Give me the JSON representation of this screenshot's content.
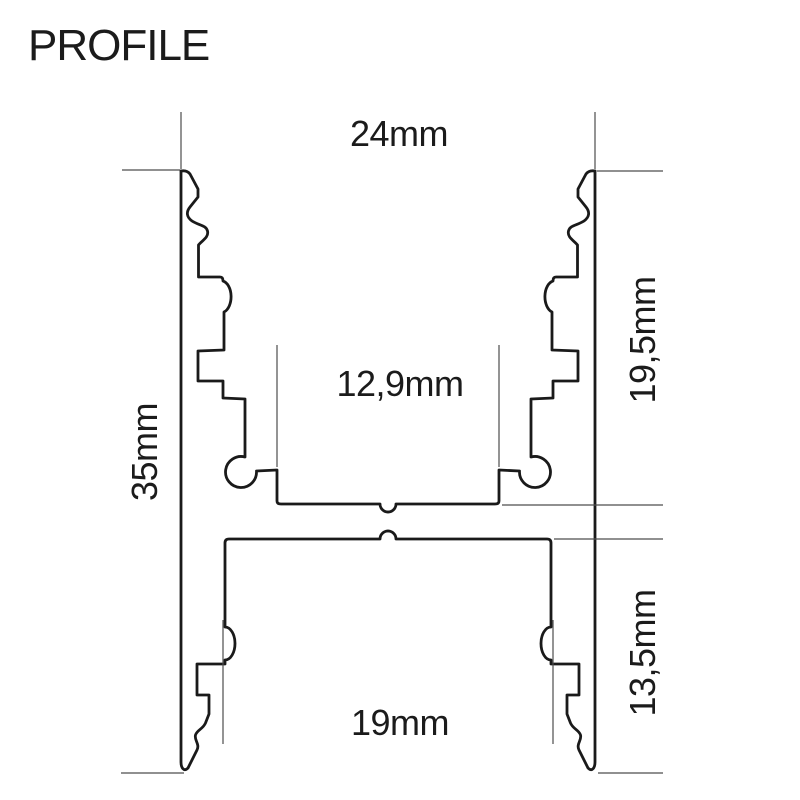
{
  "page": {
    "title": "PROFILE"
  },
  "colors": {
    "outline": "#1a1a1a",
    "extension_line": "#4d4d4d",
    "label_text": "#1b1b1b",
    "background": "#ffffff"
  },
  "dimensions": {
    "top_width": "24mm",
    "upper_section_height": "19,5mm",
    "inner_channel_width": "12,9mm",
    "total_height": "35mm",
    "lower_section_height": "13,5mm",
    "bottom_width": "19mm"
  }
}
